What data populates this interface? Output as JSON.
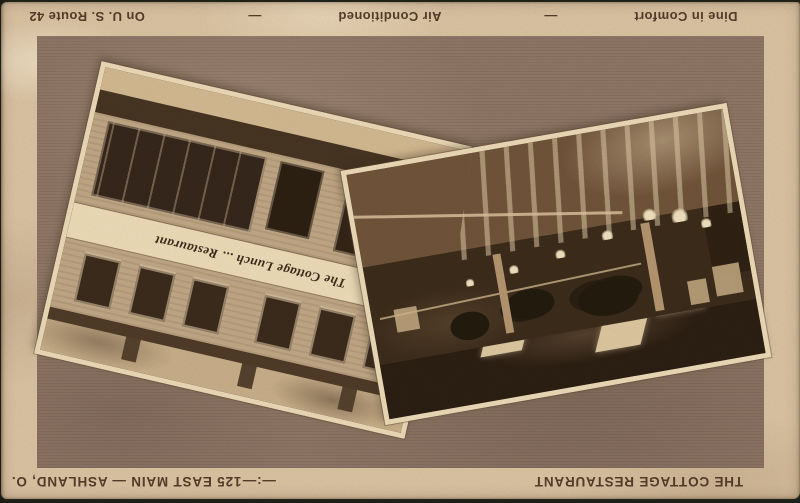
{
  "postcard": {
    "top_line": {
      "route": "On U. S. Route 42",
      "dash_a": "—",
      "air_conditioned": "Air Conditioned",
      "dash_b": "—",
      "dine": "Dine in Comfort"
    },
    "bottom_line": {
      "address": "125 EAST MAIN — ASHLAND, O.",
      "separator": "—:—",
      "title": "THE COTTAGE RESTAURANT"
    },
    "photos": {
      "exterior": {
        "sign_text": "The Cottage Lunch ... Restaurant",
        "subject": "two-story restaurant building exterior"
      },
      "interior": {
        "subject": "dining room with tables, lamps and ceiling lights"
      }
    },
    "colors": {
      "card_tan": "#d9c2a1",
      "field_brown": "#8d7463",
      "ink_brown": "#543b2a",
      "photo_border_cream": "#ead8b5"
    }
  }
}
